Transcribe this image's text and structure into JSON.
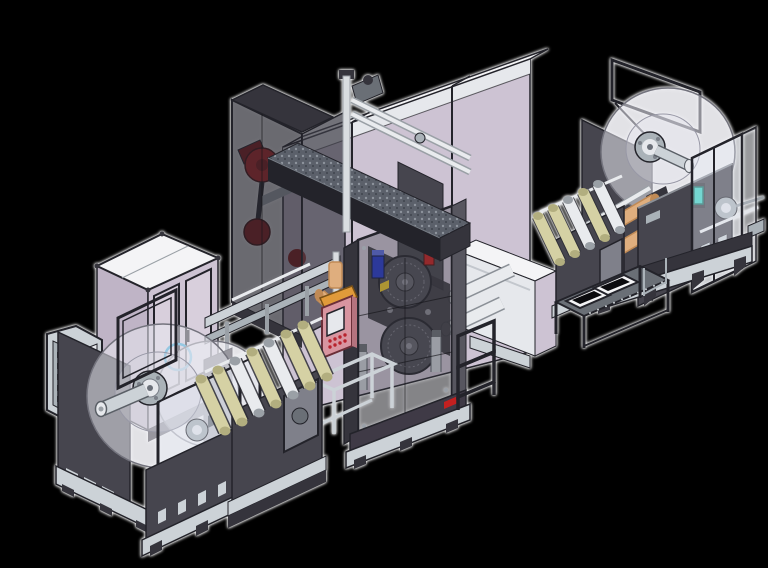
{
  "palette": {
    "bg": "#000000",
    "halo": "#ffffff",
    "dark1": "#46454e",
    "dark2": "#35343c",
    "dark3": "#23232a",
    "mid": "#6a6f76",
    "midDark": "#57565f",
    "plum_dark": "#3f3a46",
    "steel_light": "#ccd2d7",
    "steel_mid": "#aab2b8",
    "white_panel": "#f4f4f6",
    "off_white": "#e6e8ec",
    "lavender": "#cdc3d3",
    "lavender_dark": "#bfb4c6",
    "lavender_light": "#d8cfdc",
    "glass": "#dce2ec61",
    "glass_light": "#eef1f54d",
    "glass_side": "#cfd5de40",
    "glass_dark": "#262630a6",
    "glass_dark2": "#3c3c46b3",
    "glass_tower": "#3c3c4659",
    "disc": "#e9e9f08c",
    "disc_inner": "#d8d8e14d",
    "disc_stroke": "#73737d",
    "drum": "#4e4d56",
    "cream": "#d5d1a4",
    "cream_dark": "#b2ae7f",
    "tan": "#dfae7e",
    "tan_dark": "#c08a55",
    "chrome": "#e9ebee",
    "chrome_dark": "#9aa0a6",
    "red": "#c32020",
    "red_dark": "#8e1616",
    "blue": "#2438c8",
    "cyan": "#2f9fd0",
    "teal": "#35cfc0",
    "orange": "#e09a3a",
    "pink": "#d895a0",
    "yellow": "#e8c52a",
    "speckle_base": "#5b606a",
    "speckle_dot": "#8d939c"
  },
  "scene": {
    "background": "black",
    "machines": [
      {
        "id": "backing-panel-left",
        "label": "perforated backing panel"
      },
      {
        "id": "unwinder-left",
        "label": "left unwind station with roll discs"
      },
      {
        "id": "electrical-cabinet-left",
        "label": "lavender double-door cabinet"
      },
      {
        "id": "pedestal-enclosure",
        "label": "pedestal with clear guard box"
      },
      {
        "id": "roller-stand-left",
        "label": "left roller stand"
      },
      {
        "id": "rear-drive-tower",
        "label": "smoked-glass drive tower with red pulleys"
      },
      {
        "id": "overhead-conveyor",
        "label": "diagonal overhead conveyor beam with chrome rails"
      },
      {
        "id": "cabinet-bank",
        "label": "tall lavender cabinet bank"
      },
      {
        "id": "transfer-table",
        "label": "white transfer table with rollers"
      },
      {
        "id": "main-process-tower",
        "label": "central process tower with two bolted drums"
      },
      {
        "id": "pendant-hmi",
        "label": "pink pendant control with screen and buttons"
      },
      {
        "id": "roller-stand-right",
        "label": "right roller stand"
      },
      {
        "id": "tray-bench",
        "label": "bench with two white trays"
      },
      {
        "id": "rewind-station-right",
        "label": "right rewind station with clear enclosure"
      }
    ],
    "counts": {
      "cabinet_bank_sections": 3,
      "left_roller_stand_rollers": 7,
      "right_roller_stand_rollers": 5,
      "tower_drums": 2,
      "bench_trays": 2,
      "roll_discs_left": 2,
      "roll_discs_right": 1
    }
  }
}
